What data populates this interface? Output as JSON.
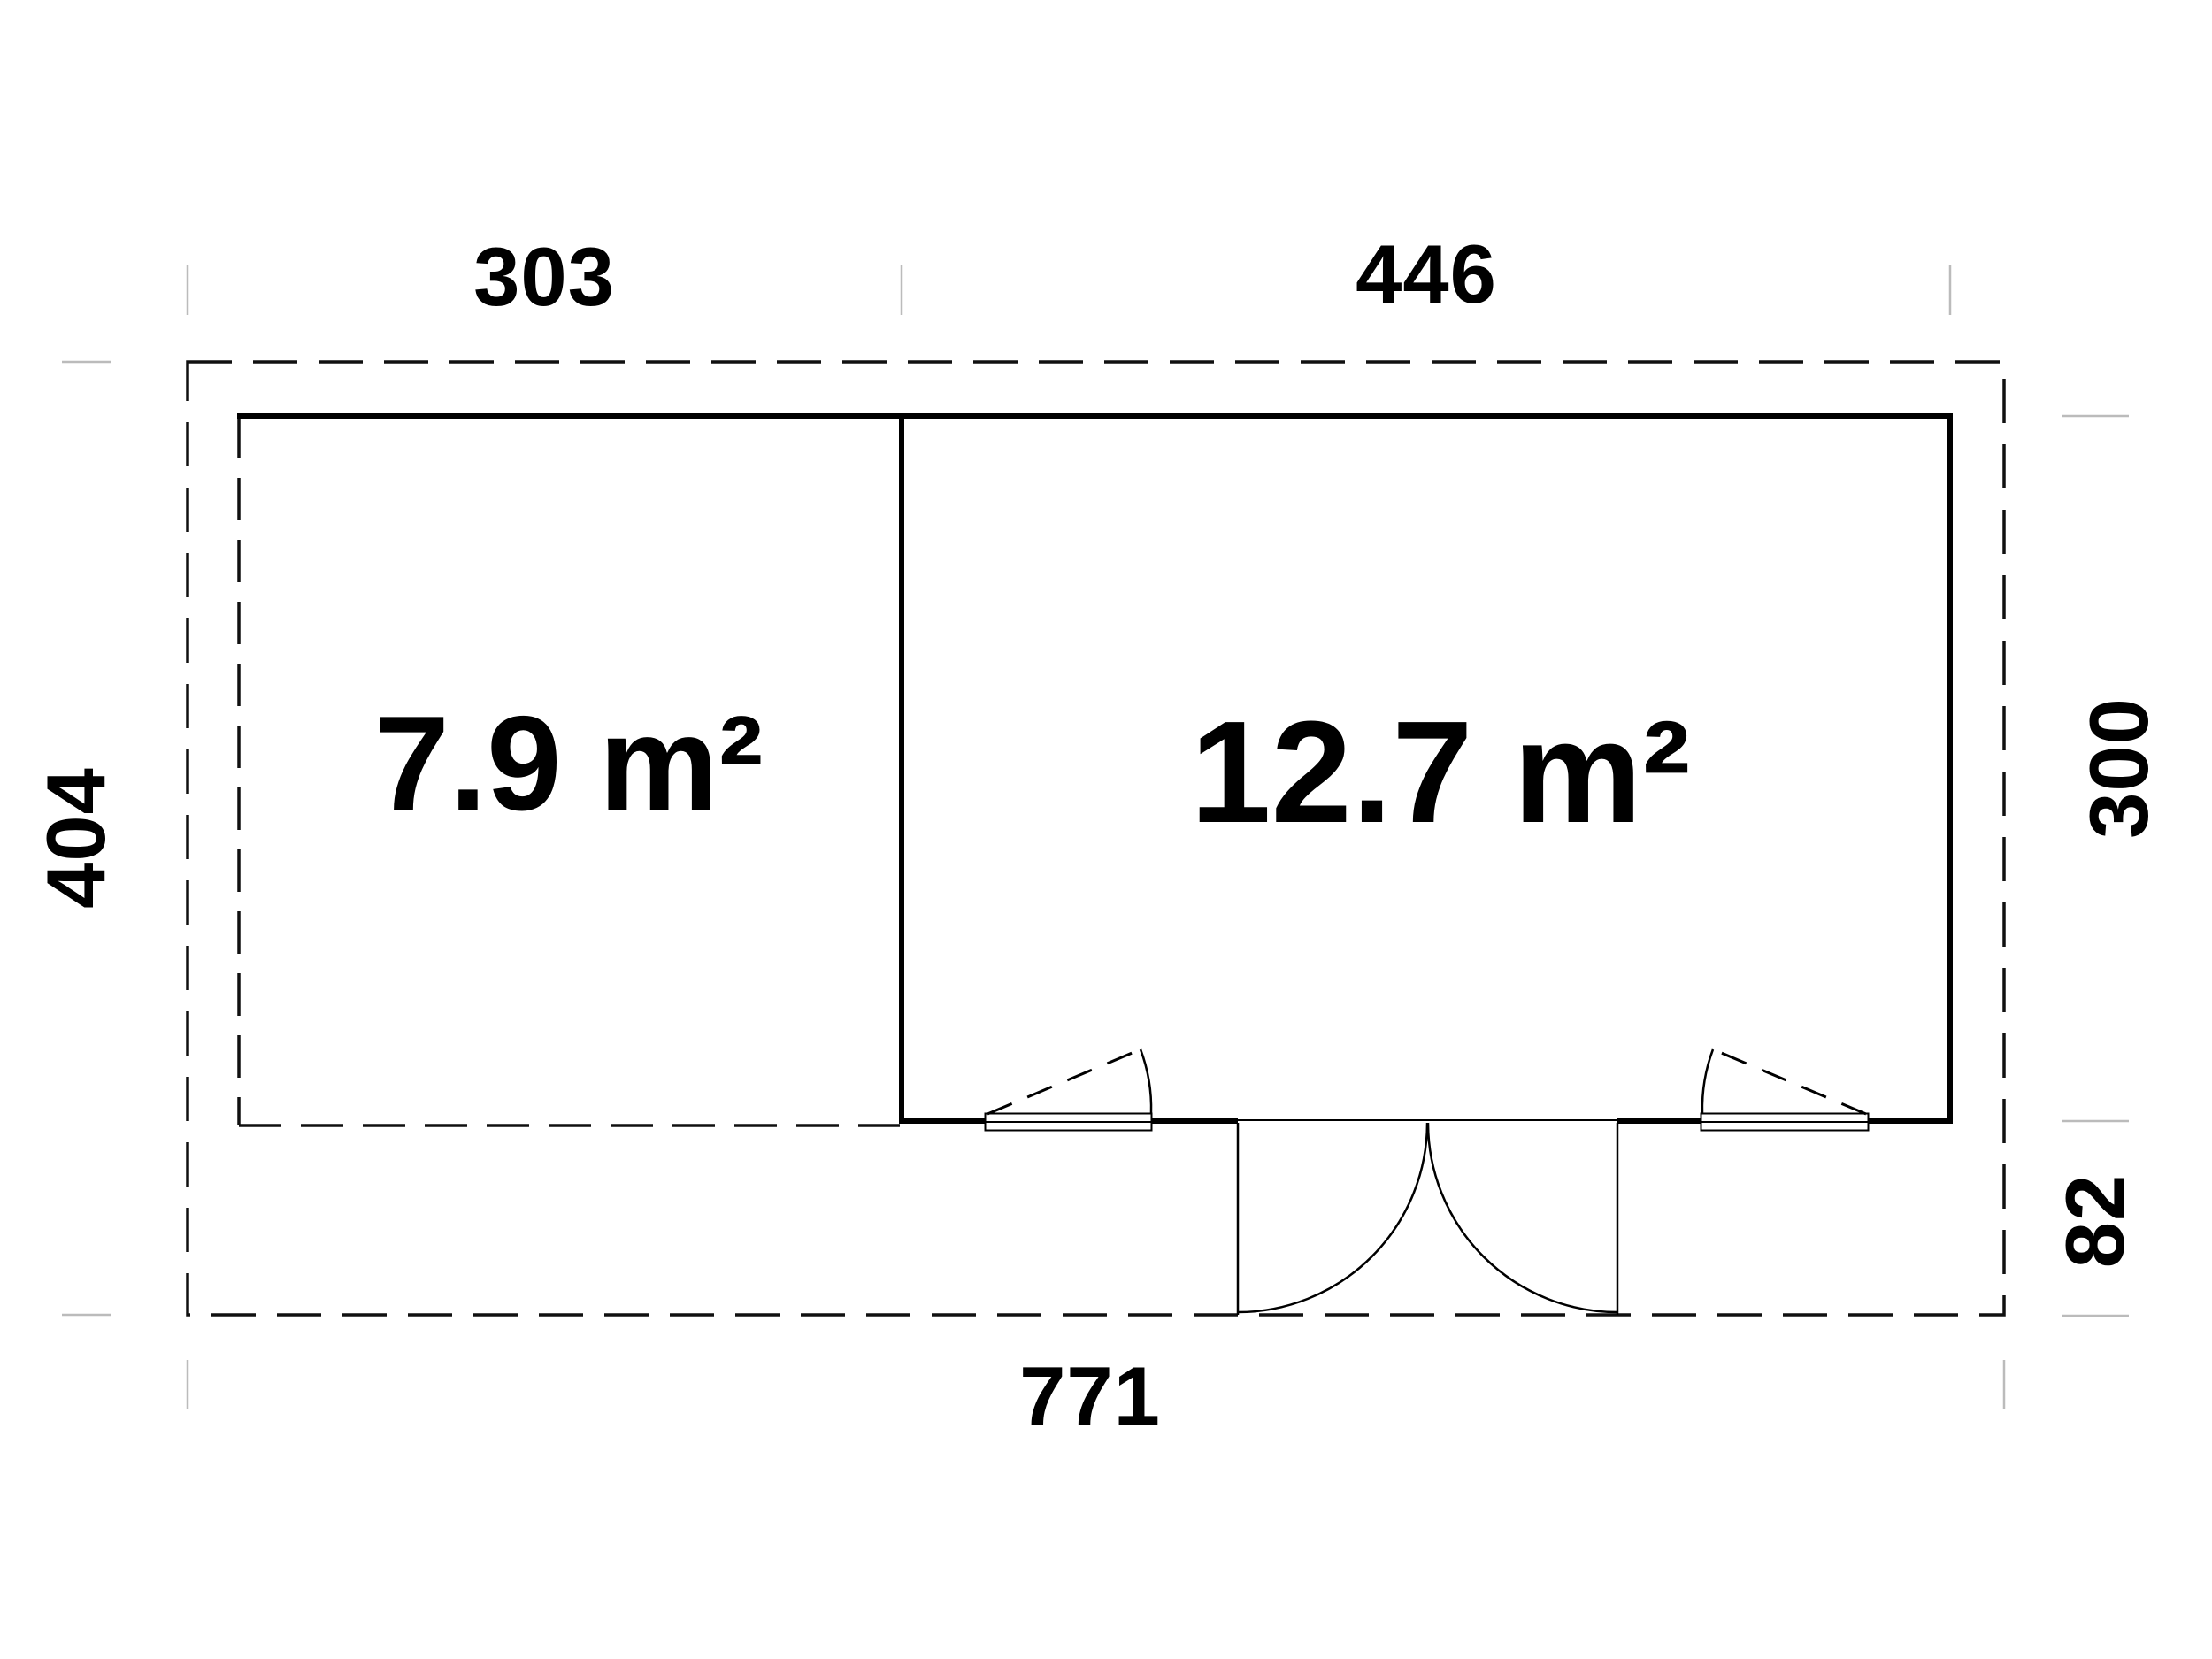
{
  "floorplan": {
    "dimensions": {
      "top_left": "303",
      "top_right": "446",
      "left": "404",
      "right_upper": "300",
      "right_lower": "82",
      "bottom": "771"
    },
    "areas": {
      "left_room": "7.9 m²",
      "right_room": "12.7 m²"
    },
    "colors": {
      "line": "#000000",
      "tick": "#bbbbbb",
      "background": "#ffffff"
    }
  }
}
